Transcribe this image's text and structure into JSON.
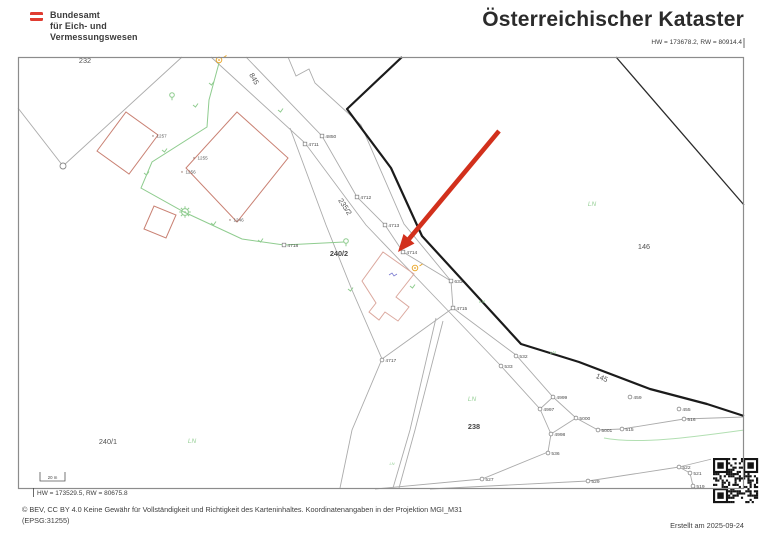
{
  "header": {
    "logo_lines": [
      "Bundesamt",
      "für Eich- und",
      "Vermessungswesen"
    ],
    "title": "Österreichischer Kataster",
    "coord_top_right": "HW = 173678.2, RW = 80914.4"
  },
  "map": {
    "coord_bottom_left": "HW = 173529.5, RW = 80675.8",
    "scale_bar_label": "20 m",
    "ln_text": "LN",
    "parcels": [
      {
        "label": "232",
        "x": 85,
        "y": 63,
        "rot": 0,
        "emph": false
      },
      {
        "label": "845",
        "x": 252,
        "y": 80,
        "rot": 60,
        "emph": false
      },
      {
        "label": "235/2",
        "x": 343,
        "y": 208,
        "rot": 57,
        "emph": false
      },
      {
        "label": "240/2",
        "x": 339,
        "y": 256,
        "rot": 0,
        "emph": true
      },
      {
        "label": "146",
        "x": 644,
        "y": 249,
        "rot": 0,
        "emph": false
      },
      {
        "label": "145",
        "x": 601,
        "y": 380,
        "rot": 22,
        "emph": false
      },
      {
        "label": "238",
        "x": 474,
        "y": 429,
        "rot": 0,
        "emph": true
      },
      {
        "label": "240/1",
        "x": 108,
        "y": 444,
        "rot": 0,
        "emph": false
      }
    ],
    "ln_labels": [
      {
        "x": 592,
        "y": 206,
        "size": 6.5
      },
      {
        "x": 482,
        "y": 303,
        "size": 4.5
      },
      {
        "x": 553,
        "y": 354,
        "size": 4.5
      },
      {
        "x": 472,
        "y": 401,
        "size": 6.5
      },
      {
        "x": 192,
        "y": 443,
        "size": 6.5
      },
      {
        "x": 392,
        "y": 465,
        "size": 4
      }
    ],
    "points": [
      {
        "label": "4850",
        "x": 322,
        "y": 136,
        "m": "sq"
      },
      {
        "label": "4711",
        "x": 305,
        "y": 144,
        "m": "sq"
      },
      {
        "label": "4712",
        "x": 357,
        "y": 197,
        "m": "sq"
      },
      {
        "label": "4713",
        "x": 385,
        "y": 225,
        "m": "sq"
      },
      {
        "label": "4714",
        "x": 403,
        "y": 252,
        "m": "sq"
      },
      {
        "label": "4718",
        "x": 284,
        "y": 245,
        "m": "sq"
      },
      {
        "label": "633",
        "x": 451,
        "y": 281,
        "m": "sq"
      },
      {
        "label": "4715",
        "x": 453,
        "y": 308,
        "m": "sq"
      },
      {
        "label": "4717",
        "x": 382,
        "y": 360,
        "m": "c"
      },
      {
        "label": "532",
        "x": 516,
        "y": 356,
        "m": "c"
      },
      {
        "label": "533",
        "x": 501,
        "y": 366,
        "m": "c"
      },
      {
        "label": "4999",
        "x": 553,
        "y": 397,
        "m": "c"
      },
      {
        "label": "4997",
        "x": 540,
        "y": 409,
        "m": "c"
      },
      {
        "label": "5000",
        "x": 576,
        "y": 418,
        "m": "c"
      },
      {
        "label": "5001",
        "x": 598,
        "y": 430,
        "m": "c"
      },
      {
        "label": "515",
        "x": 622,
        "y": 429,
        "m": "c"
      },
      {
        "label": "516",
        "x": 684,
        "y": 419,
        "m": "c"
      },
      {
        "label": "459",
        "x": 630,
        "y": 397,
        "m": "c"
      },
      {
        "label": "455",
        "x": 679,
        "y": 409,
        "m": "c"
      },
      {
        "label": "4998",
        "x": 551,
        "y": 434,
        "m": "c"
      },
      {
        "label": "536",
        "x": 548,
        "y": 453,
        "m": "c"
      },
      {
        "label": "527",
        "x": 482,
        "y": 479,
        "m": "c"
      },
      {
        "label": "529",
        "x": 588,
        "y": 481,
        "m": "c"
      },
      {
        "label": "522",
        "x": 679,
        "y": 467,
        "m": "c"
      },
      {
        "label": "521",
        "x": 690,
        "y": 473,
        "m": "c"
      },
      {
        "label": "519",
        "x": 693,
        "y": 486,
        "m": "c"
      }
    ],
    "building_points": [
      {
        "label": "1257",
        "x": 153,
        "y": 136
      },
      {
        "label": "1255",
        "x": 194,
        "y": 158
      },
      {
        "label": "1256",
        "x": 182,
        "y": 172
      },
      {
        "label": "1246",
        "x": 230,
        "y": 220
      }
    ]
  },
  "footer": {
    "copyright_line1": "© BEV, CC BY 4.0 Keine Gewähr für Vollständigkeit und Richtigkeit des Karteninhaltes. Koordinatenangaben in der Projektion  MGI_M31",
    "copyright_line2": "(EPSG:31255)",
    "created": "Erstellt am 2025-09-24"
  },
  "colors": {
    "arrow_red": "#d2301c",
    "building_red": "#c98173",
    "building_light_red": "#dba89e",
    "vegetation_green": "#8fcc8f",
    "symbol_orange": "#e8a21f",
    "line_gray": "#ababab",
    "boundary_black": "#1b1b1b",
    "flag_red": "#e03c31"
  }
}
